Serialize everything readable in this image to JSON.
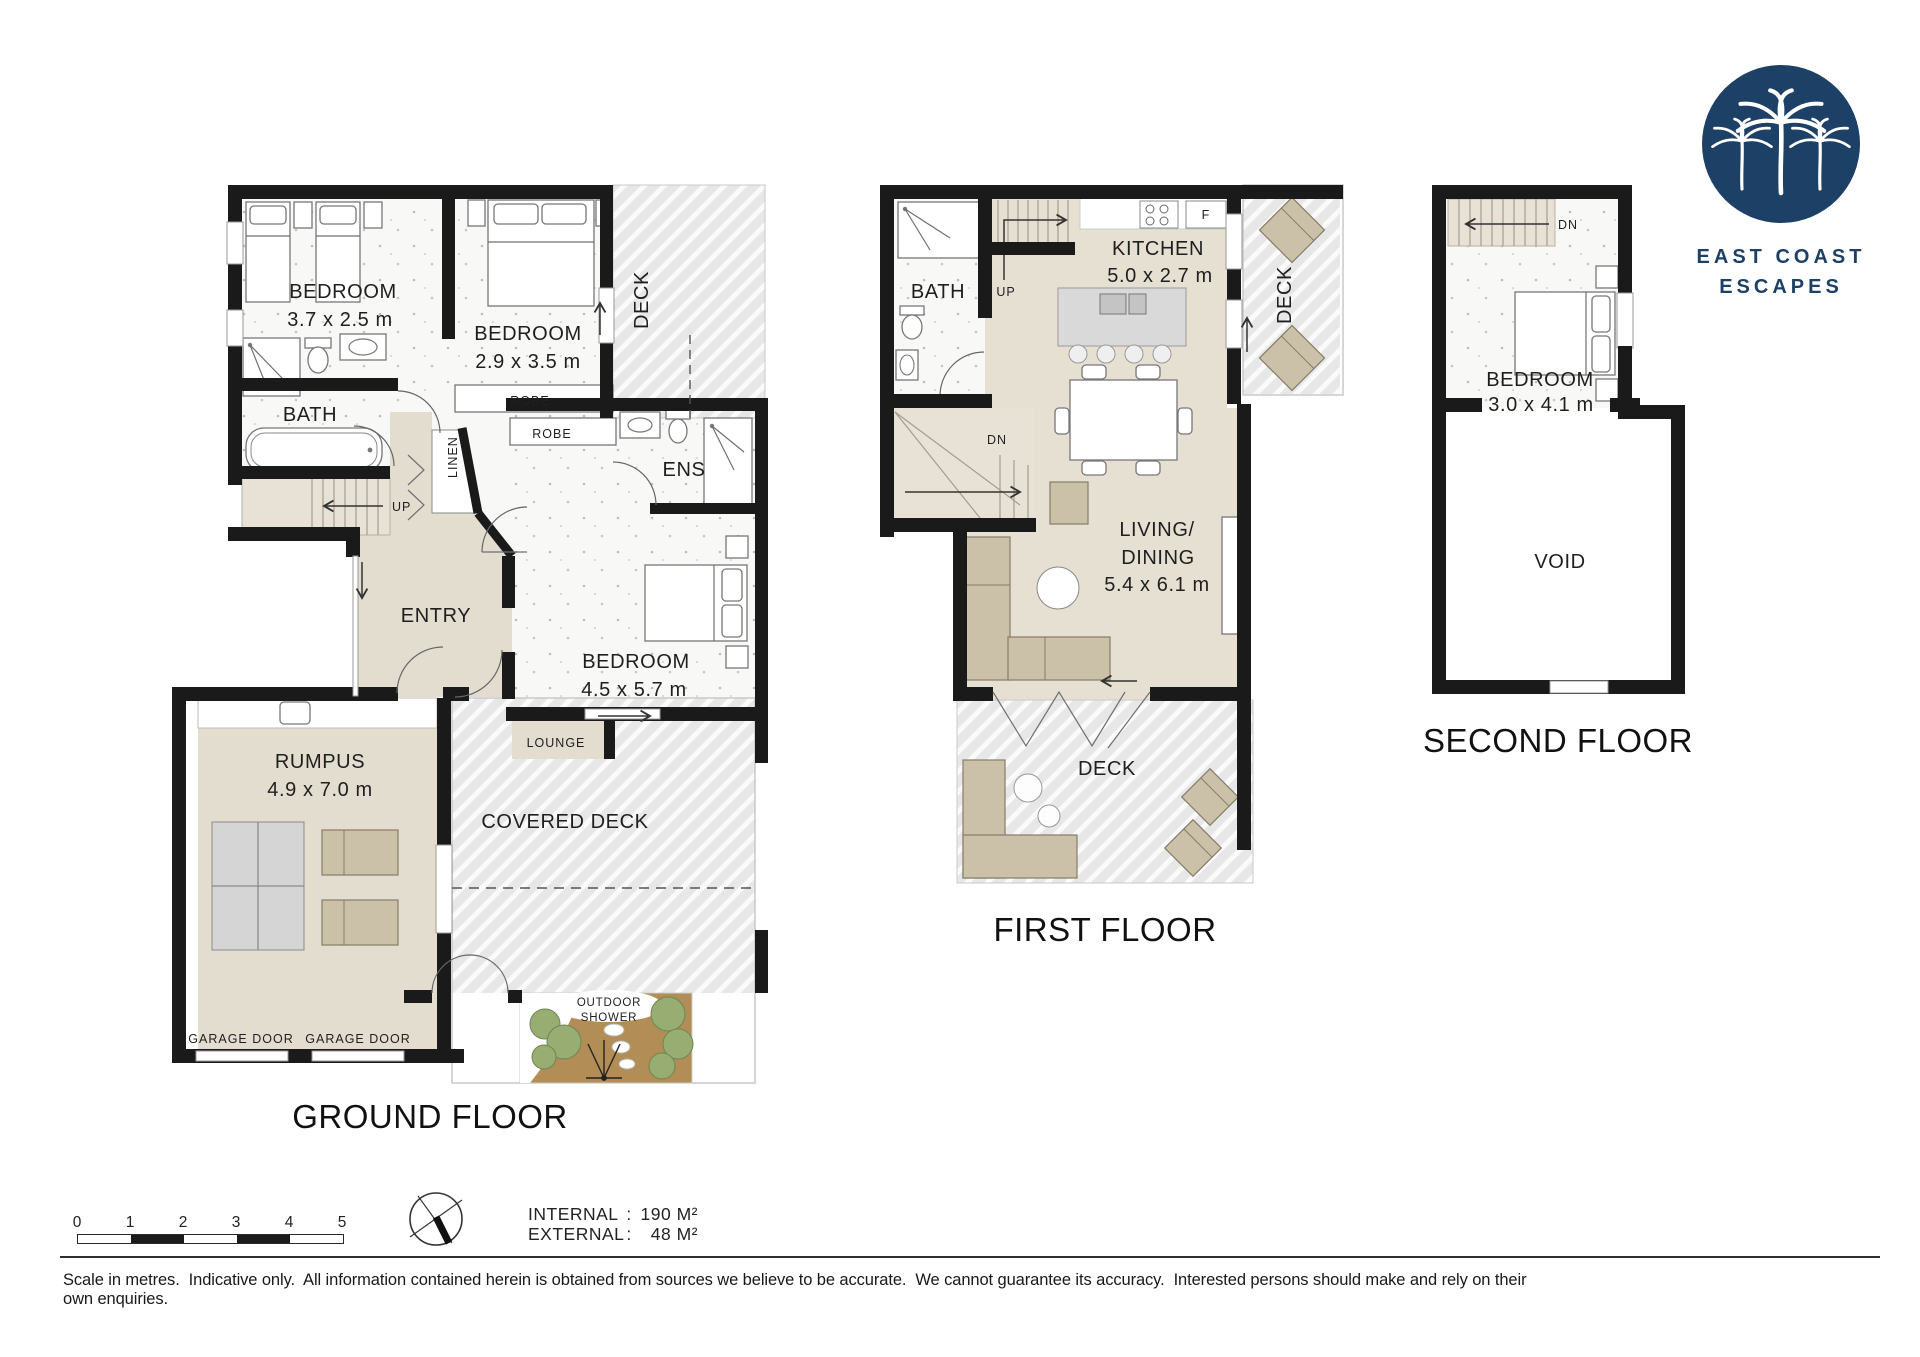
{
  "logo": {
    "name_line1": "EAST COAST",
    "name_line2": "ESCAPES"
  },
  "ground": {
    "title": "GROUND FLOOR",
    "bedroom1_name": "BEDROOM",
    "bedroom1_dims": "3.7 x 2.5 m",
    "bedroom2_name": "BEDROOM",
    "bedroom2_dims": "2.9 x 3.5 m",
    "bedroom3_name": "BEDROOM",
    "bedroom3_dims": "4.5 x 5.7 m",
    "bath": "BATH",
    "ens": "ENS",
    "entry": "ENTRY",
    "rumpus_name": "RUMPUS",
    "rumpus_dims": "4.9 x 7.0 m",
    "deck": "DECK",
    "covered_deck": "COVERED DECK",
    "lounge": "LOUNGE",
    "robe1": "ROBE",
    "robe2": "ROBE",
    "linen": "LINEN",
    "up": "UP",
    "garage_door1": "GARAGE DOOR",
    "garage_door2": "GARAGE DOOR",
    "outdoor_shower_line1": "OUTDOOR",
    "outdoor_shower_line2": "SHOWER"
  },
  "first": {
    "title": "FIRST FLOOR",
    "bath": "BATH",
    "up": "UP",
    "dn": "DN",
    "fridge": "F",
    "kitchen_name": "KITCHEN",
    "kitchen_dims": "5.0 x 2.7 m",
    "living_line1": "LIVING/",
    "living_line2": "DINING",
    "living_dims": "5.4 x 6.1 m",
    "deck_side": "DECK",
    "deck_rear": "DECK"
  },
  "second": {
    "title": "SECOND FLOOR",
    "bedroom_name": "BEDROOM",
    "bedroom_dims": "3.0 x 4.1 m",
    "void": "VOID",
    "dn": "DN"
  },
  "footer": {
    "scale_ticks": [
      "0",
      "1",
      "2",
      "3",
      "4",
      "5"
    ],
    "areas": {
      "internal_label": "INTERNAL",
      "internal_value": "190 M²",
      "external_label": "EXTERNAL",
      "external_value": "48 M²",
      "separator": ":"
    },
    "disclaimer": "Scale in metres.  Indicative only.  All information contained herein is obtained from sources we believe to be accurate.  We cannot guarantee its accuracy.  Interested persons should make and rely on their own enquiries."
  },
  "colors": {
    "wall": "#1a1a1a",
    "floor_light": "#f8f8f7",
    "floor_beige": "#e3ddd0",
    "deck_grey": "#e7e7e8",
    "furniture_beige": "#cbc1a8",
    "logo_navy": "#1d4066",
    "garden_brown": "#b28d55",
    "tree_green": "#97ad72"
  }
}
